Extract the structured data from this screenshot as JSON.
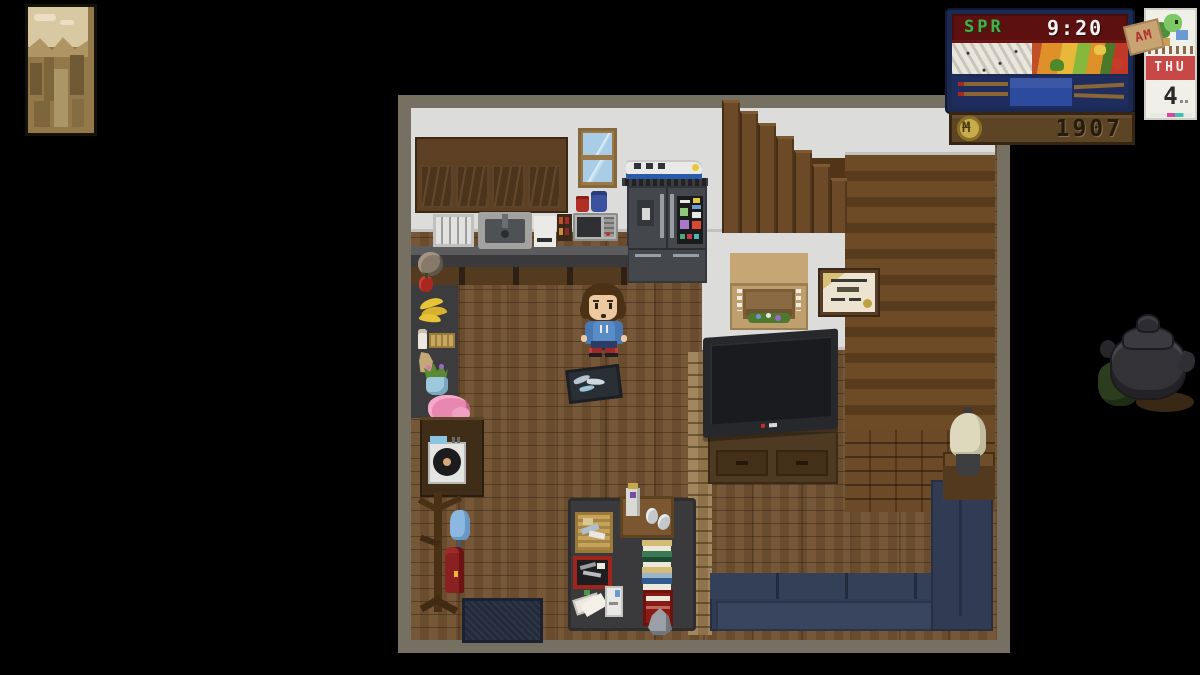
{
  "hud": {
    "clock": {
      "season": "SPR",
      "time": "9:20"
    },
    "calendar": {
      "meridiem": "AM",
      "weekday": "THU",
      "day": "4"
    },
    "wallet": {
      "symbol": "M",
      "amount": "1907"
    }
  },
  "colors": {
    "background": "#000000",
    "room_border": "#767062",
    "wall": "#dcdcda",
    "floor_wood": "#6f5030",
    "couch_navy": "#313c54",
    "hud_panel_navy": "#1c2a52",
    "hud_screen_red": "#5c1010",
    "season_green": "#46b04a",
    "time_white": "#f2f2f2",
    "calendar_band_red": "#c84848",
    "money_wood": "#5c4425",
    "coin_gold": "#c8ac4c"
  },
  "scene": {
    "description": "pixel-art farmhouse interior, player standing in living room",
    "objects": [
      "sepia-painting",
      "kitchen-cabinets",
      "window",
      "toy-train",
      "refrigerator",
      "dish-rack",
      "sink",
      "backsplash-towel",
      "spice-rack",
      "microwave",
      "red-mug",
      "blue-mug",
      "wreath",
      "apple",
      "bananas",
      "crate",
      "bottle",
      "paper-bag",
      "vase-plant",
      "pink-flower-basket",
      "record-player",
      "coat-rack",
      "umbrella",
      "red-coat",
      "door-mat",
      "coffee-table",
      "fish-basket",
      "wooden-tray",
      "jar",
      "book-stack",
      "toolbox",
      "papers",
      "white-box",
      "magazine-rack",
      "crystal",
      "player-character",
      "floor-tray-with-fish",
      "staircase",
      "fireplace-mantel",
      "framed-certificate",
      "television",
      "tv-stand",
      "sectional-couch",
      "side-table",
      "table-lamp",
      "dark-teapot"
    ]
  }
}
